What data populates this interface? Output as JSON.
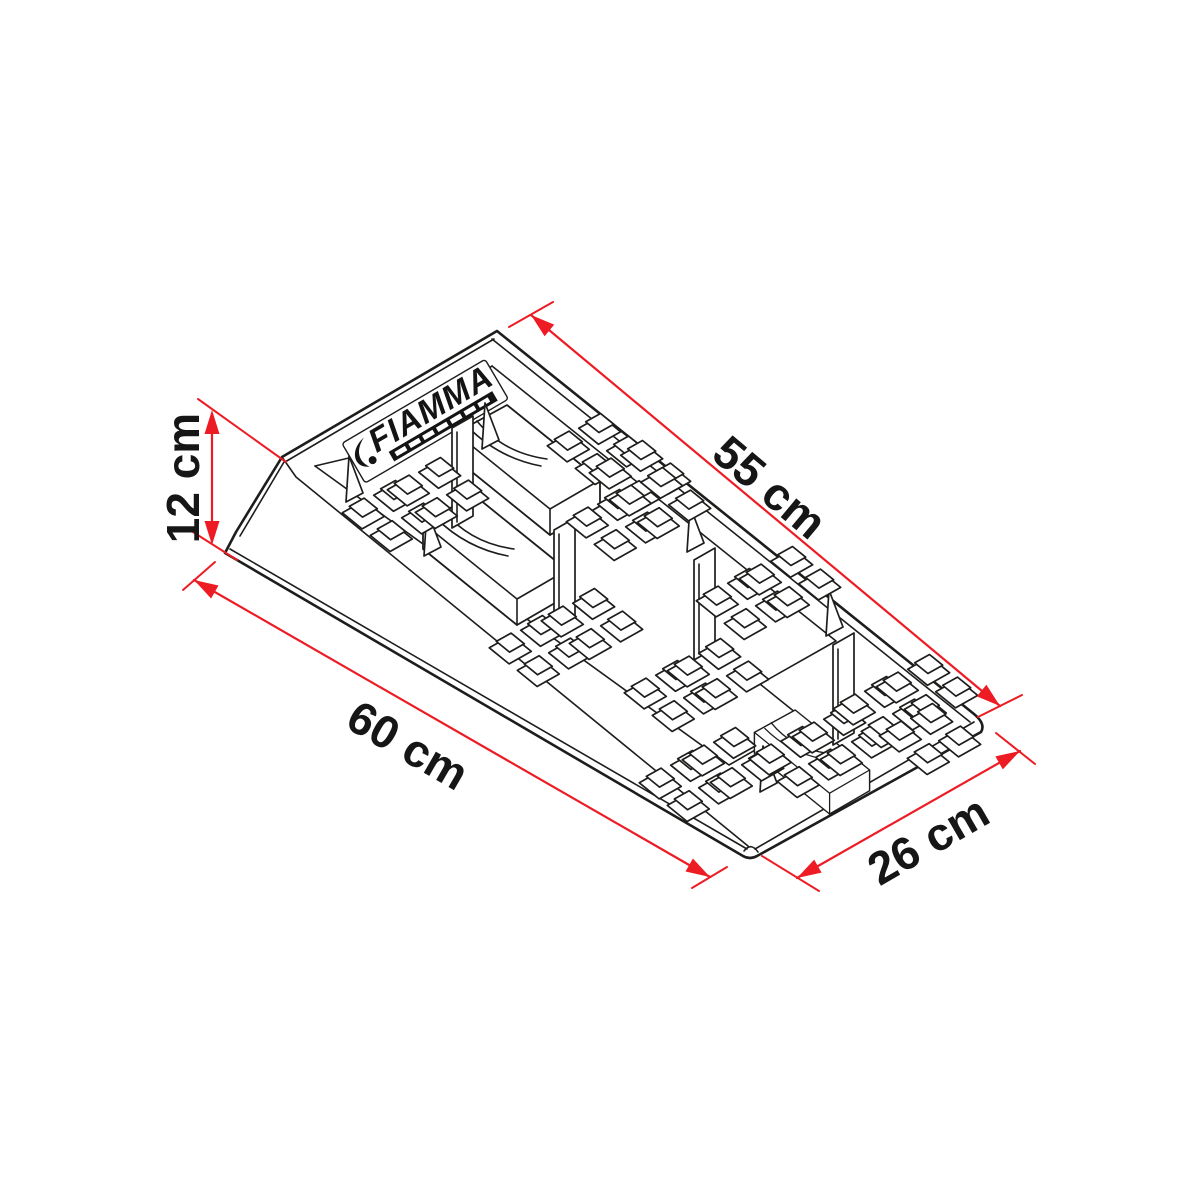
{
  "diagram": {
    "type": "product-dimension-drawing",
    "product": {
      "brand": "FIAMMA",
      "kind": "leveling ramp wedge"
    },
    "dimensions": [
      {
        "name": "height",
        "label": "12 cm"
      },
      {
        "name": "top-length",
        "label": "55 cm"
      },
      {
        "name": "base-length",
        "label": "60 cm"
      },
      {
        "name": "width",
        "label": "26 cm"
      }
    ],
    "colors": {
      "dimension_red": "#ed1c24",
      "line_black": "#1d1d1b",
      "background": "#ffffff"
    }
  }
}
